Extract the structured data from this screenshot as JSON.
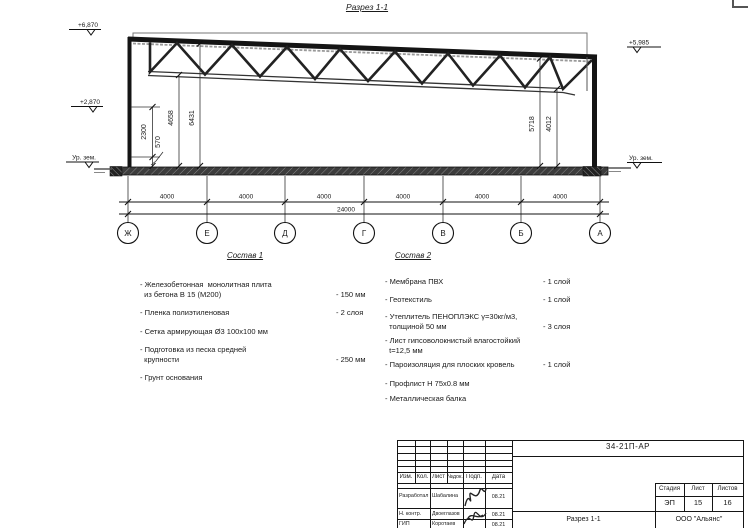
{
  "drawing": {
    "section_title": "Разрез 1-1",
    "elevations": {
      "top_left": "+6,870",
      "mid_left": "+2,870",
      "ground_left": "Ур. зем.",
      "top_right": "+5,985",
      "ground_right": "Ур. зем."
    },
    "vertical_dims": [
      "2300",
      "570",
      "4658",
      "6431",
      "5718",
      "4012"
    ],
    "bay_dims": [
      "4000",
      "4000",
      "4000",
      "4000",
      "4000",
      "4000"
    ],
    "total_dim": "24000",
    "axes": [
      "Ж",
      "Е",
      "Д",
      "Г",
      "В",
      "Б",
      "А"
    ]
  },
  "sostav1": {
    "heading": "Состав 1",
    "items": [
      {
        "name": "- Железобетонная  монолитная плита\n  из бетона В 15 (М200)",
        "value": "- 150 мм"
      },
      {
        "name": "- Пленка полиэтиленовая",
        "value": "- 2 слоя"
      },
      {
        "name": "- Сетка армирующая Ø3 100х100 мм",
        "value": ""
      },
      {
        "name": "- Подготовка из песка средней\n  крупности",
        "value": "- 250 мм"
      },
      {
        "name": "- Грунт основания",
        "value": ""
      }
    ]
  },
  "sostav2": {
    "heading": "Состав 2",
    "items": [
      {
        "name": "- Мембрана ПВХ",
        "value": "- 1 слой"
      },
      {
        "name": "- Геотекстиль",
        "value": "- 1 слой"
      },
      {
        "name": "- Утеплитель ПЕНОПЛЭКС γ=30кг/м3,\n  толщиной 50 мм",
        "value": "- 3 слоя"
      },
      {
        "name": "- Лист гипсоволокнистый влагостойкий\n  t=12,5 мм",
        "value": ""
      },
      {
        "name": "- Пароизоляция для плоских кровель",
        "value": "- 1 слой"
      },
      {
        "name": "- Профлист Н 75х0.8 мм",
        "value": ""
      },
      {
        "name": "- Металлическая балка",
        "value": ""
      }
    ]
  },
  "titleblock": {
    "doc_number": "34-21П-АР",
    "header_cols": [
      "Изм.",
      "Кол.",
      "Лист",
      "№док.",
      "Подп.",
      "Дата"
    ],
    "rows": [
      {
        "role": "Разработал",
        "name": "Шабалина",
        "date": "08.21"
      },
      {
        "role": "Н. контр.",
        "name": "Двоеглазов",
        "date": "08.21"
      },
      {
        "role": "ГИП",
        "name": "Коротаев",
        "date": "08.21"
      }
    ],
    "stage_cols": [
      "Стадия",
      "Лист",
      "Листов"
    ],
    "stage_vals": [
      "ЭП",
      "15",
      "16"
    ],
    "drawing_title": "Разрез 1-1",
    "company": "ООО \"Альянс\""
  }
}
